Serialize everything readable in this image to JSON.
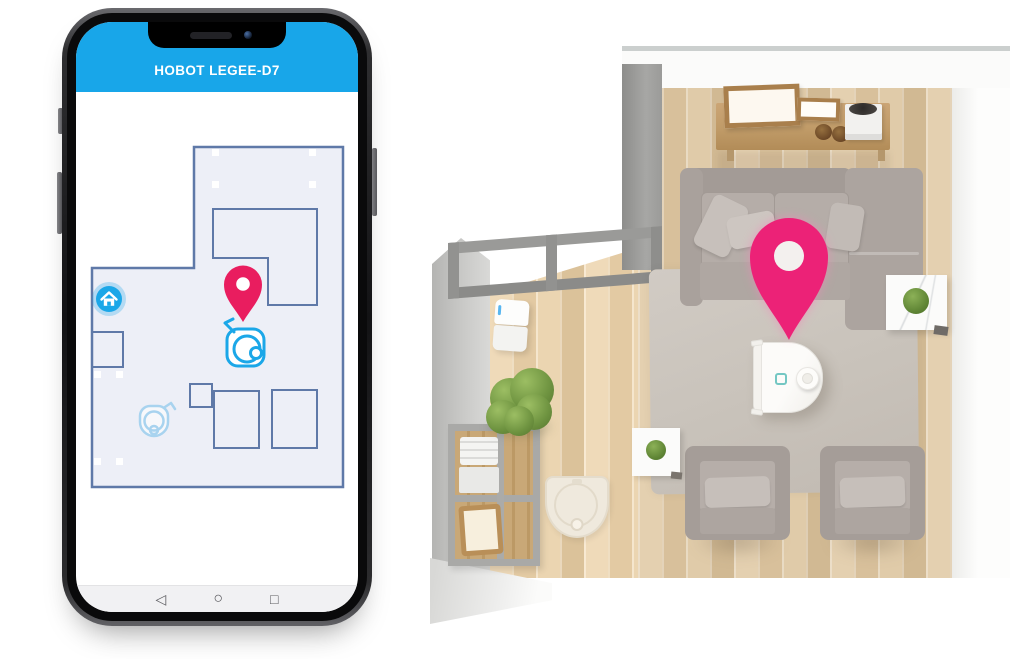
{
  "phone": {
    "header": {
      "title": "HOBOT LEGEE-D7",
      "bg_color": "#18A6E9",
      "text_color": "#FFFFFF"
    },
    "map": {
      "floor_fill": "#EDEFF7",
      "wall_color": "#5F79A8",
      "pin_color": "#E91D5F",
      "robot_icon_color": "#1BA7E8",
      "dock_icon_color": "#A8D3EF",
      "home_button_color": "#1BA7E8"
    },
    "nav_bar": {
      "back_glyph": "◁",
      "home_glyph": "○",
      "recents_glyph": "□"
    }
  },
  "room_illustration": {
    "pin_color": "#EC2277",
    "floor_color": "#DEC8A6",
    "wall_color": "#C6C6C4",
    "sofa_color": "#ABA39E",
    "rug_color": "#CBC5BD",
    "robot_body_color": "#F8F6F3"
  }
}
